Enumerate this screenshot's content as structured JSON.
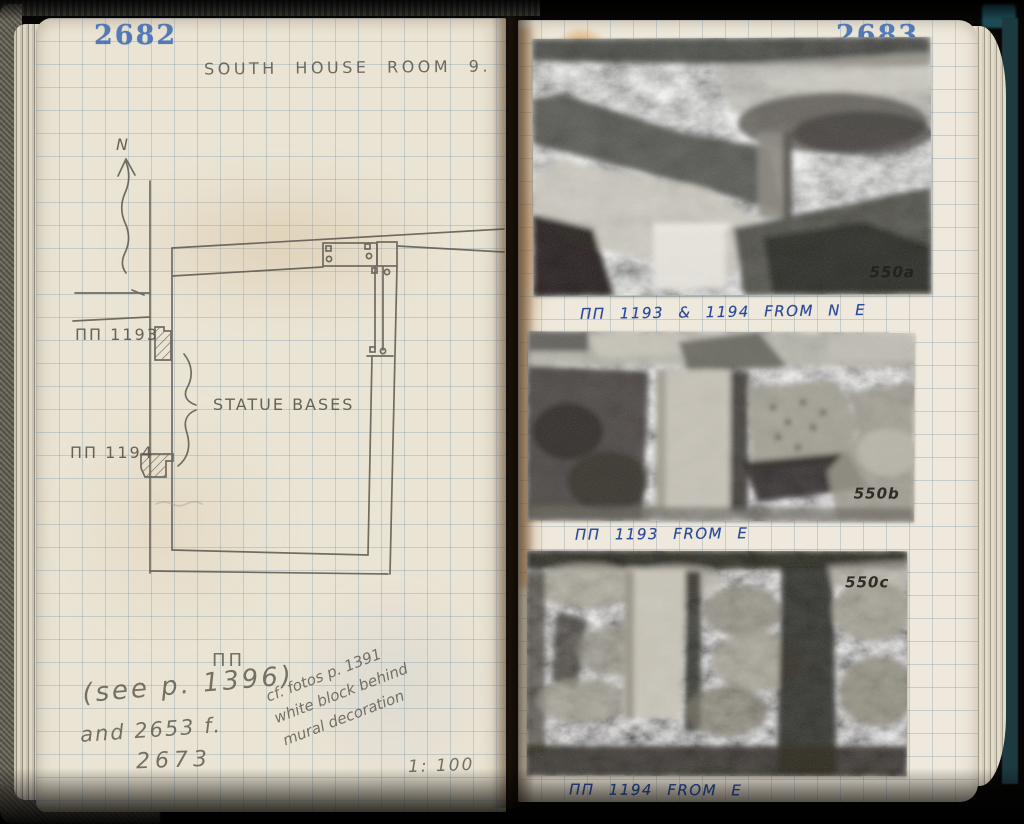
{
  "colors": {
    "paper_cream": "#ebe5d6",
    "grid_blue": "#7691a8",
    "stamp_blue": "#3f6cb3",
    "ink_blue": "#2c4a9a",
    "pencil_grey": "#59544a",
    "rust_stain": "#c4701e"
  },
  "book": {
    "left_page": {
      "page_number": "2682",
      "title": "SOUTH HOUSE ROOM 9.",
      "plan": {
        "north_label": "N",
        "base_label_1": "ΠΠ 1193",
        "base_label_2": "ΠΠ 1194",
        "bases_caption": "STATUE BASES"
      },
      "notes": {
        "pi_ref": "ΠΠ",
        "see_ref": "(see p. 1396)",
        "and_ref": "and 2653 f.",
        "extra_ref": "2673",
        "diagonal_note_line1": "cf. fotos p. 1391",
        "diagonal_note_line2": "white block behind",
        "diagonal_note_line3": "mural decoration",
        "scale": "1: 100"
      }
    },
    "right_page": {
      "page_number": "2683",
      "photos": [
        {
          "id": "550a",
          "caption": "ΠΠ 1193 & 1194 FROM N E"
        },
        {
          "id": "550b",
          "caption": "ΠΠ 1193 FROM E"
        },
        {
          "id": "550c",
          "caption": "ΠΠ 1194 FROM E"
        }
      ]
    }
  }
}
